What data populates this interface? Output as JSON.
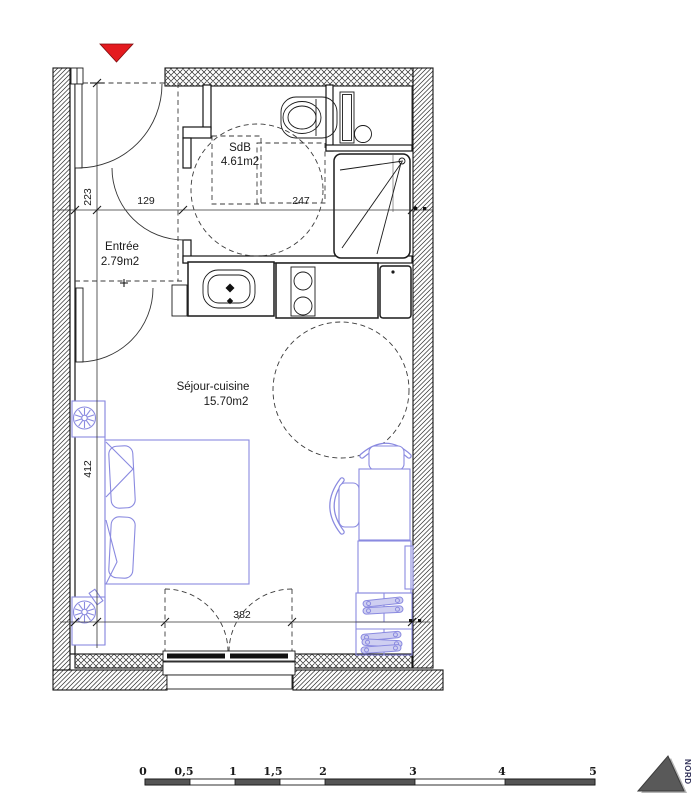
{
  "plan": {
    "rooms": {
      "bathroom": {
        "name": "SdB",
        "area": "4.61m2"
      },
      "entrance": {
        "name": "Entrée",
        "area": "2.79m2"
      },
      "living": {
        "name": "Séjour-cuisine",
        "area": "15.70m2"
      }
    },
    "dimensions": {
      "entrance_depth": "223",
      "entrance_width": "129",
      "bathroom_width": "247",
      "living_height": "412",
      "window_width": "382"
    }
  },
  "scale_bar": {
    "labels": [
      "0",
      "0,5",
      "1",
      "1,5",
      "2",
      "3",
      "4",
      "5"
    ]
  },
  "compass": {
    "label": "NORD"
  },
  "colors": {
    "furniture": "#8a8ae0",
    "entrance_marker": "#e41b1f",
    "north_triangle": "#595959"
  }
}
